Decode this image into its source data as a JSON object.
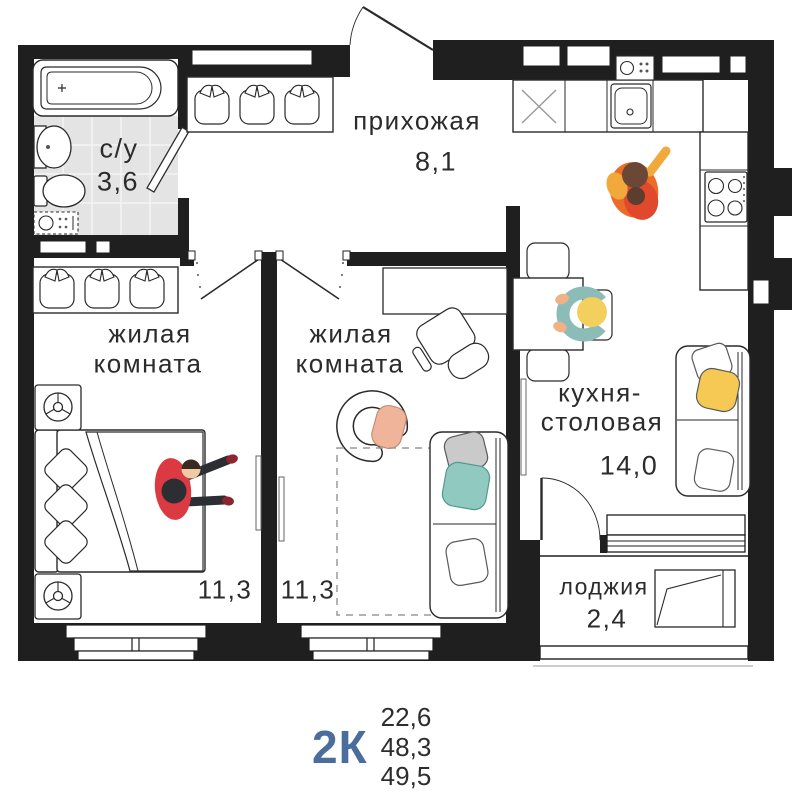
{
  "floorplan": {
    "rooms": {
      "bathroom": {
        "name": "с/у",
        "area": "3,6"
      },
      "hallway": {
        "name": "прихожая",
        "area": "8,1"
      },
      "living_room_1": {
        "name_line_1": "жилая",
        "name_line_2": "комната",
        "area": "11,3"
      },
      "living_room_2": {
        "name_line_1": "жилая",
        "name_line_2": "комната",
        "area": "11,3"
      },
      "kitchen_dining": {
        "name_line_1": "кухня-",
        "name_line_2": "столовая",
        "area": "14,0"
      },
      "loggia": {
        "name": "лоджия",
        "area": "2,4"
      }
    },
    "summary": {
      "apartment_type": "2К",
      "area_1": "22,6",
      "area_2": "48,3",
      "area_3": "49,5"
    },
    "colors": {
      "walls": "#1f1f1f",
      "accent_blue": "#4a6d9b",
      "bathroom_tile": "#e4e4e4",
      "person_orange": "#ed6b28",
      "person_red": "#dc3a42",
      "person_teal": "#8cbcb7",
      "head_yellow": "#f3d05e",
      "pillow_yellow": "#f5c954",
      "pillow_teal": "#8fc9bf",
      "pillow_gray": "#cacaca",
      "pillow_peach": "#efb49a"
    }
  }
}
